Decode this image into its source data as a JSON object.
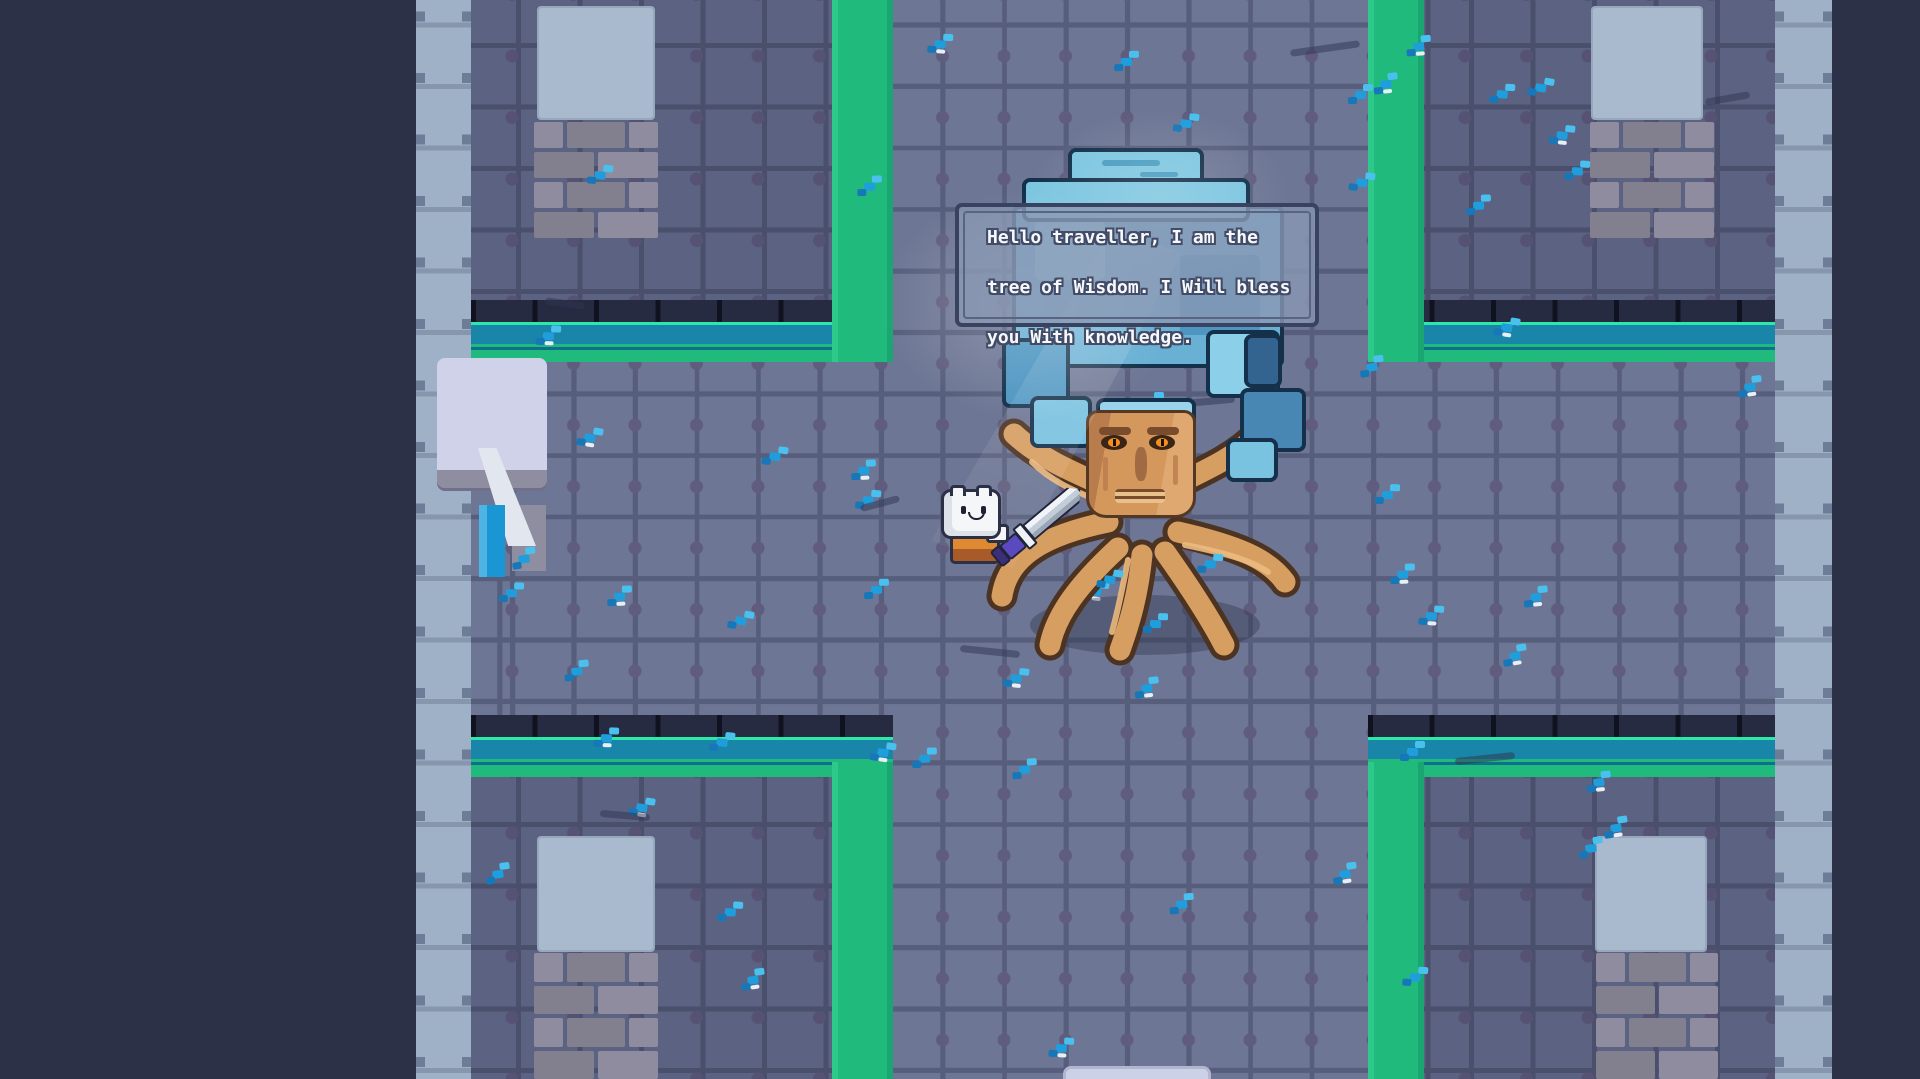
{
  "app": {
    "type": "game",
    "view": "top-down dungeon room"
  },
  "dialog": {
    "speaker": "tree-of-wisdom",
    "lines": [
      "Hello traveller, I am the",
      "tree of Wisdom. I Will bless",
      "you With knowledge."
    ]
  },
  "entities": {
    "player": {
      "name": "player-character",
      "holding": "sword"
    },
    "npc": {
      "name": "tree-of-wisdom",
      "description": "large tree with carved face, blue crystal canopy and spreading roots"
    }
  },
  "colors": {
    "background": "#2d3147",
    "floor": "#6d7694",
    "wall_tile": "#5b6282",
    "outer_wall": "#9fb1c7",
    "path_green": "#21ba7d",
    "path_teal": "#1985a9",
    "path_highlight": "#2de9a9",
    "flower_blue": "#1f9ede",
    "canopy_blue": "#6fb6d8",
    "trunk_tan": "#d4975c",
    "dialog_fill": "#8a98b4",
    "dialog_border": "#39425e",
    "dialog_text": "#f5f8fc"
  }
}
